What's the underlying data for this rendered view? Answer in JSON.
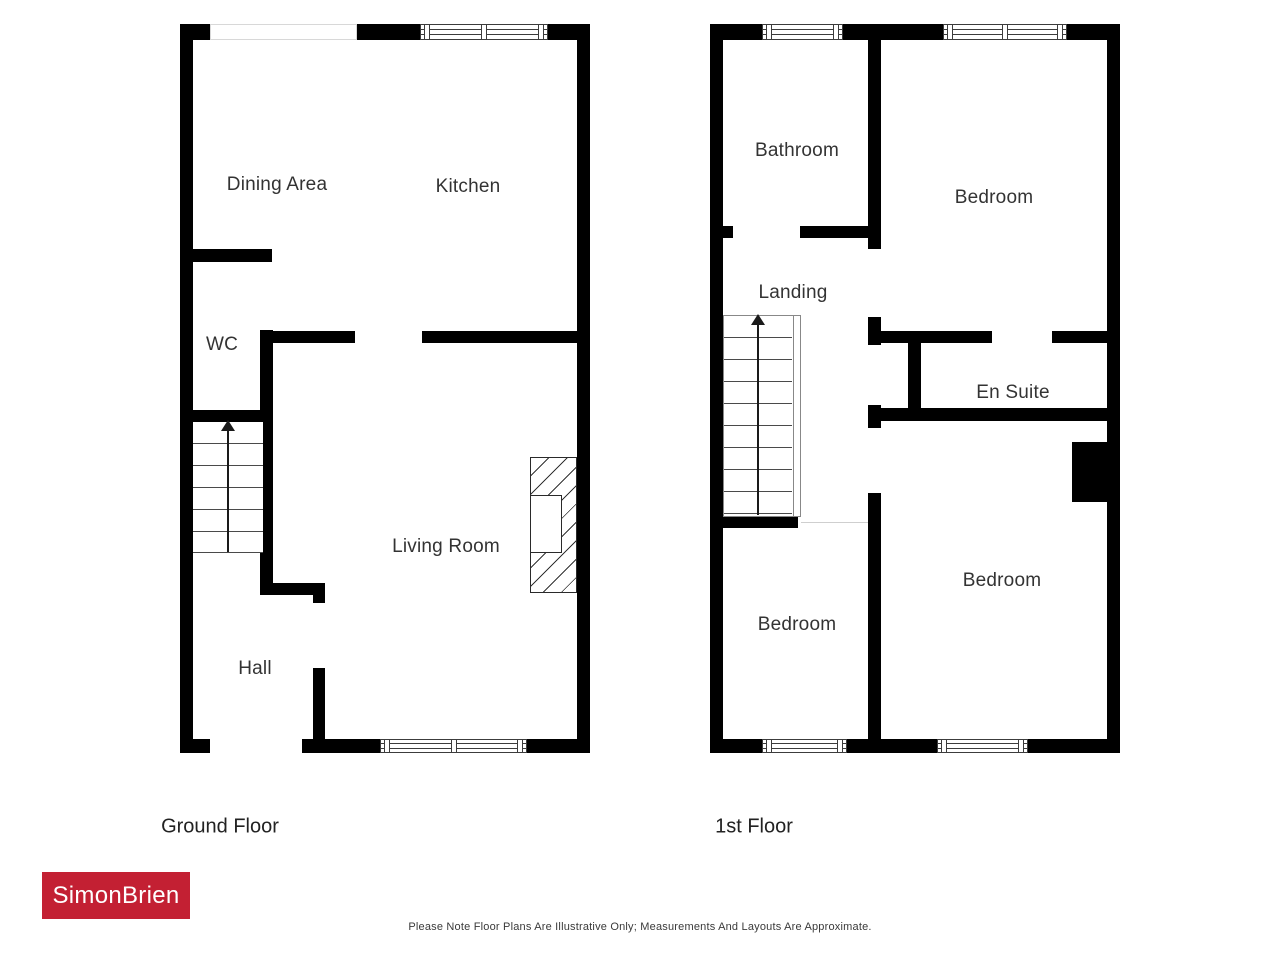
{
  "plan": {
    "floors": [
      {
        "title": "Ground Floor",
        "rooms": {
          "dining": "Dining Area",
          "kitchen": "Kitchen",
          "wc": "WC",
          "living": "Living Room",
          "hall": "Hall"
        }
      },
      {
        "title": "1st Floor",
        "rooms": {
          "bathroom": "Bathroom",
          "bedroom_top": "Bedroom",
          "landing": "Landing",
          "ensuite": "En Suite",
          "bedroom_left": "Bedroom",
          "bedroom_right": "Bedroom"
        }
      }
    ]
  },
  "branding": {
    "logo_text": "SimonBrien",
    "logo_background": "#c32033",
    "logo_text_color": "#ffffff"
  },
  "footer": {
    "disclaimer": "Please Note Floor Plans Are Illustrative Only; Measurements And Layouts Are Approximate."
  },
  "colors": {
    "wall": "#000000",
    "label": "#333333"
  }
}
